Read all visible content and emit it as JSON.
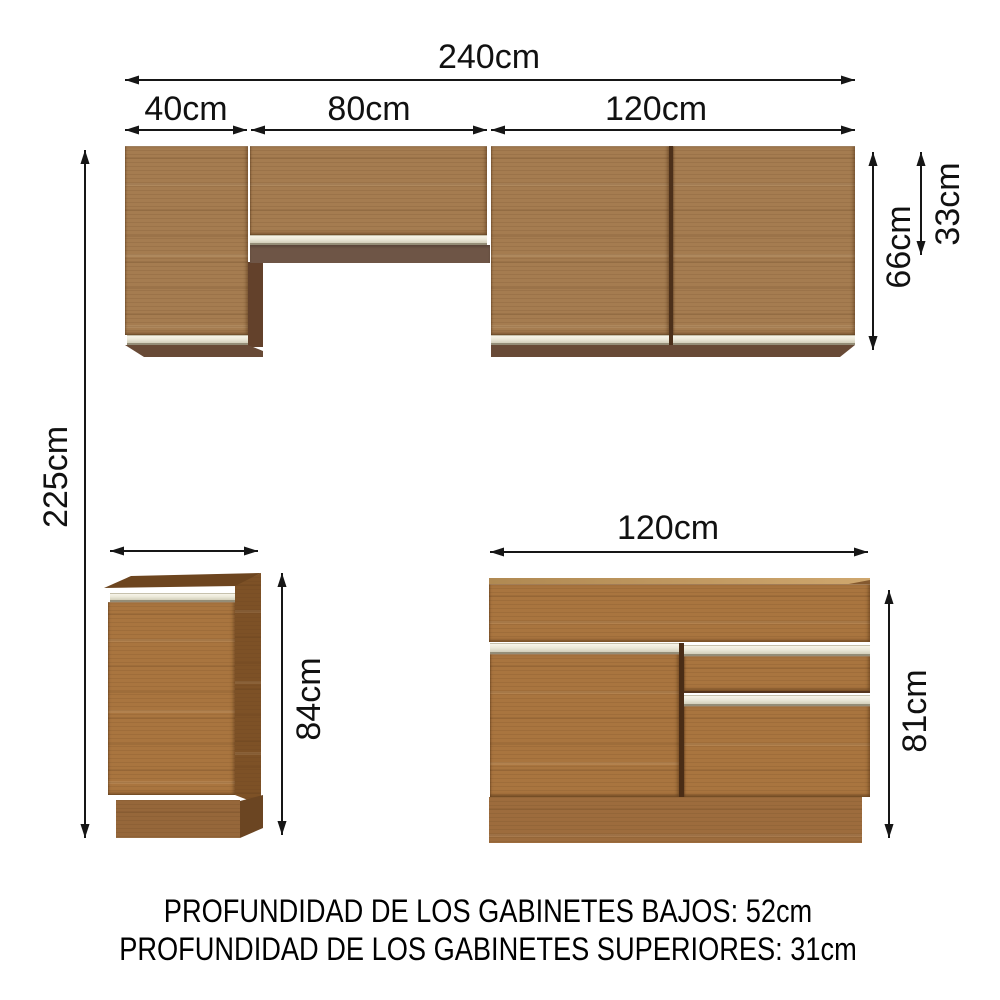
{
  "dimensions": {
    "overall_width": "240cm",
    "overall_height": "225cm",
    "upper_sections": [
      "40cm",
      "80cm",
      "120cm"
    ],
    "upper_tall_cabinet_height": "66cm",
    "upper_short_cabinet_height": "33cm",
    "base_small_cabinet_height": "84cm",
    "sink_cabinet_width": "120cm",
    "sink_cabinet_height": "81cm"
  },
  "notes": {
    "depth_lower": "PROFUNDIDAD DE LOS GABINETES BAJOS: 52cm",
    "depth_upper": "PROFUNDIDAD DE LOS GABINETES SUPERIORES: 31cm"
  },
  "colors": {
    "wood_front_tan": "#a57c50",
    "wood_front_orange": "#a9753f",
    "wood_side_dark": "#7d5126",
    "wood_underside": "#684a36",
    "wood_shelf": "#6e5546",
    "handle_cream": "#ece9da",
    "dimension_line": "#161616",
    "background": "#ffffff"
  }
}
